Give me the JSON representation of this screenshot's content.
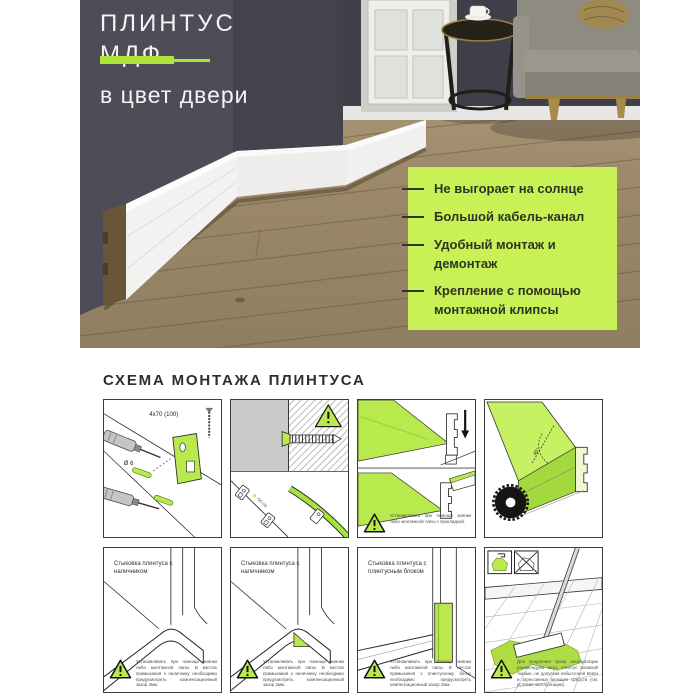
{
  "hero": {
    "title_line1": "ПЛИНТУС",
    "title_line2": "МДФ",
    "subtitle": "в цвет двери",
    "features": {
      "items": [
        {
          "label": "Не выгорает на солнце"
        },
        {
          "label": "Большой кабель-канал"
        },
        {
          "label": "Удобный монтаж и демонтаж"
        },
        {
          "label": "Крепление с помощью монтажной клипсы"
        }
      ]
    }
  },
  "scheme": {
    "heading": "СХЕМА МОНТАЖА ПЛИНТУСА",
    "panel1": {
      "screw_label": "4x70 (100)",
      "dowel_label": "Ø 6"
    },
    "panel2": {
      "spacing_label": "~50 см",
      "warning_mark": "!"
    },
    "panel3": {
      "note": "Устанавливать при помощи киянки либо монтажной лапы с прокладкой."
    },
    "panel4": {
      "angle_label": "45°"
    },
    "panel5": {
      "caption": "Стыковка плинтуса с наличником",
      "note": "Устанавливать при помощи киянки либо монтажной лапы. В местах примыкания к наличнику необходимо предусмотреть компенсационный зазор 2мм."
    },
    "panel6": {
      "caption": "Стыковка плинтуса с наличником",
      "note": "Устанавливать при помощи киянки либо монтажной лапы. В местах примыкания к наличнику необходимо предусмотреть компенсационный зазор 2мм."
    },
    "panel7": {
      "caption": "Стыковка плинтуса с плинтусным блоком",
      "note": "Устанавливать при помощи киянки либо монтажной лапы. В местах примыкания к плинтусному блоку необходимо предусмотреть компенсационный зазор 2мм."
    },
    "panel8": {
      "note": "Для продления срока эксплуатации рекомендуем мыть плинтус влажной тканью, не допуская избыточной влаги и агрессивных моющих средств (см. условия эксплуатации)."
    }
  },
  "colors": {
    "accent_green": "#aee43c",
    "feature_box_green": "#c8f155",
    "wall_dark": "#4d4c57",
    "text_dark": "#2f3522"
  }
}
